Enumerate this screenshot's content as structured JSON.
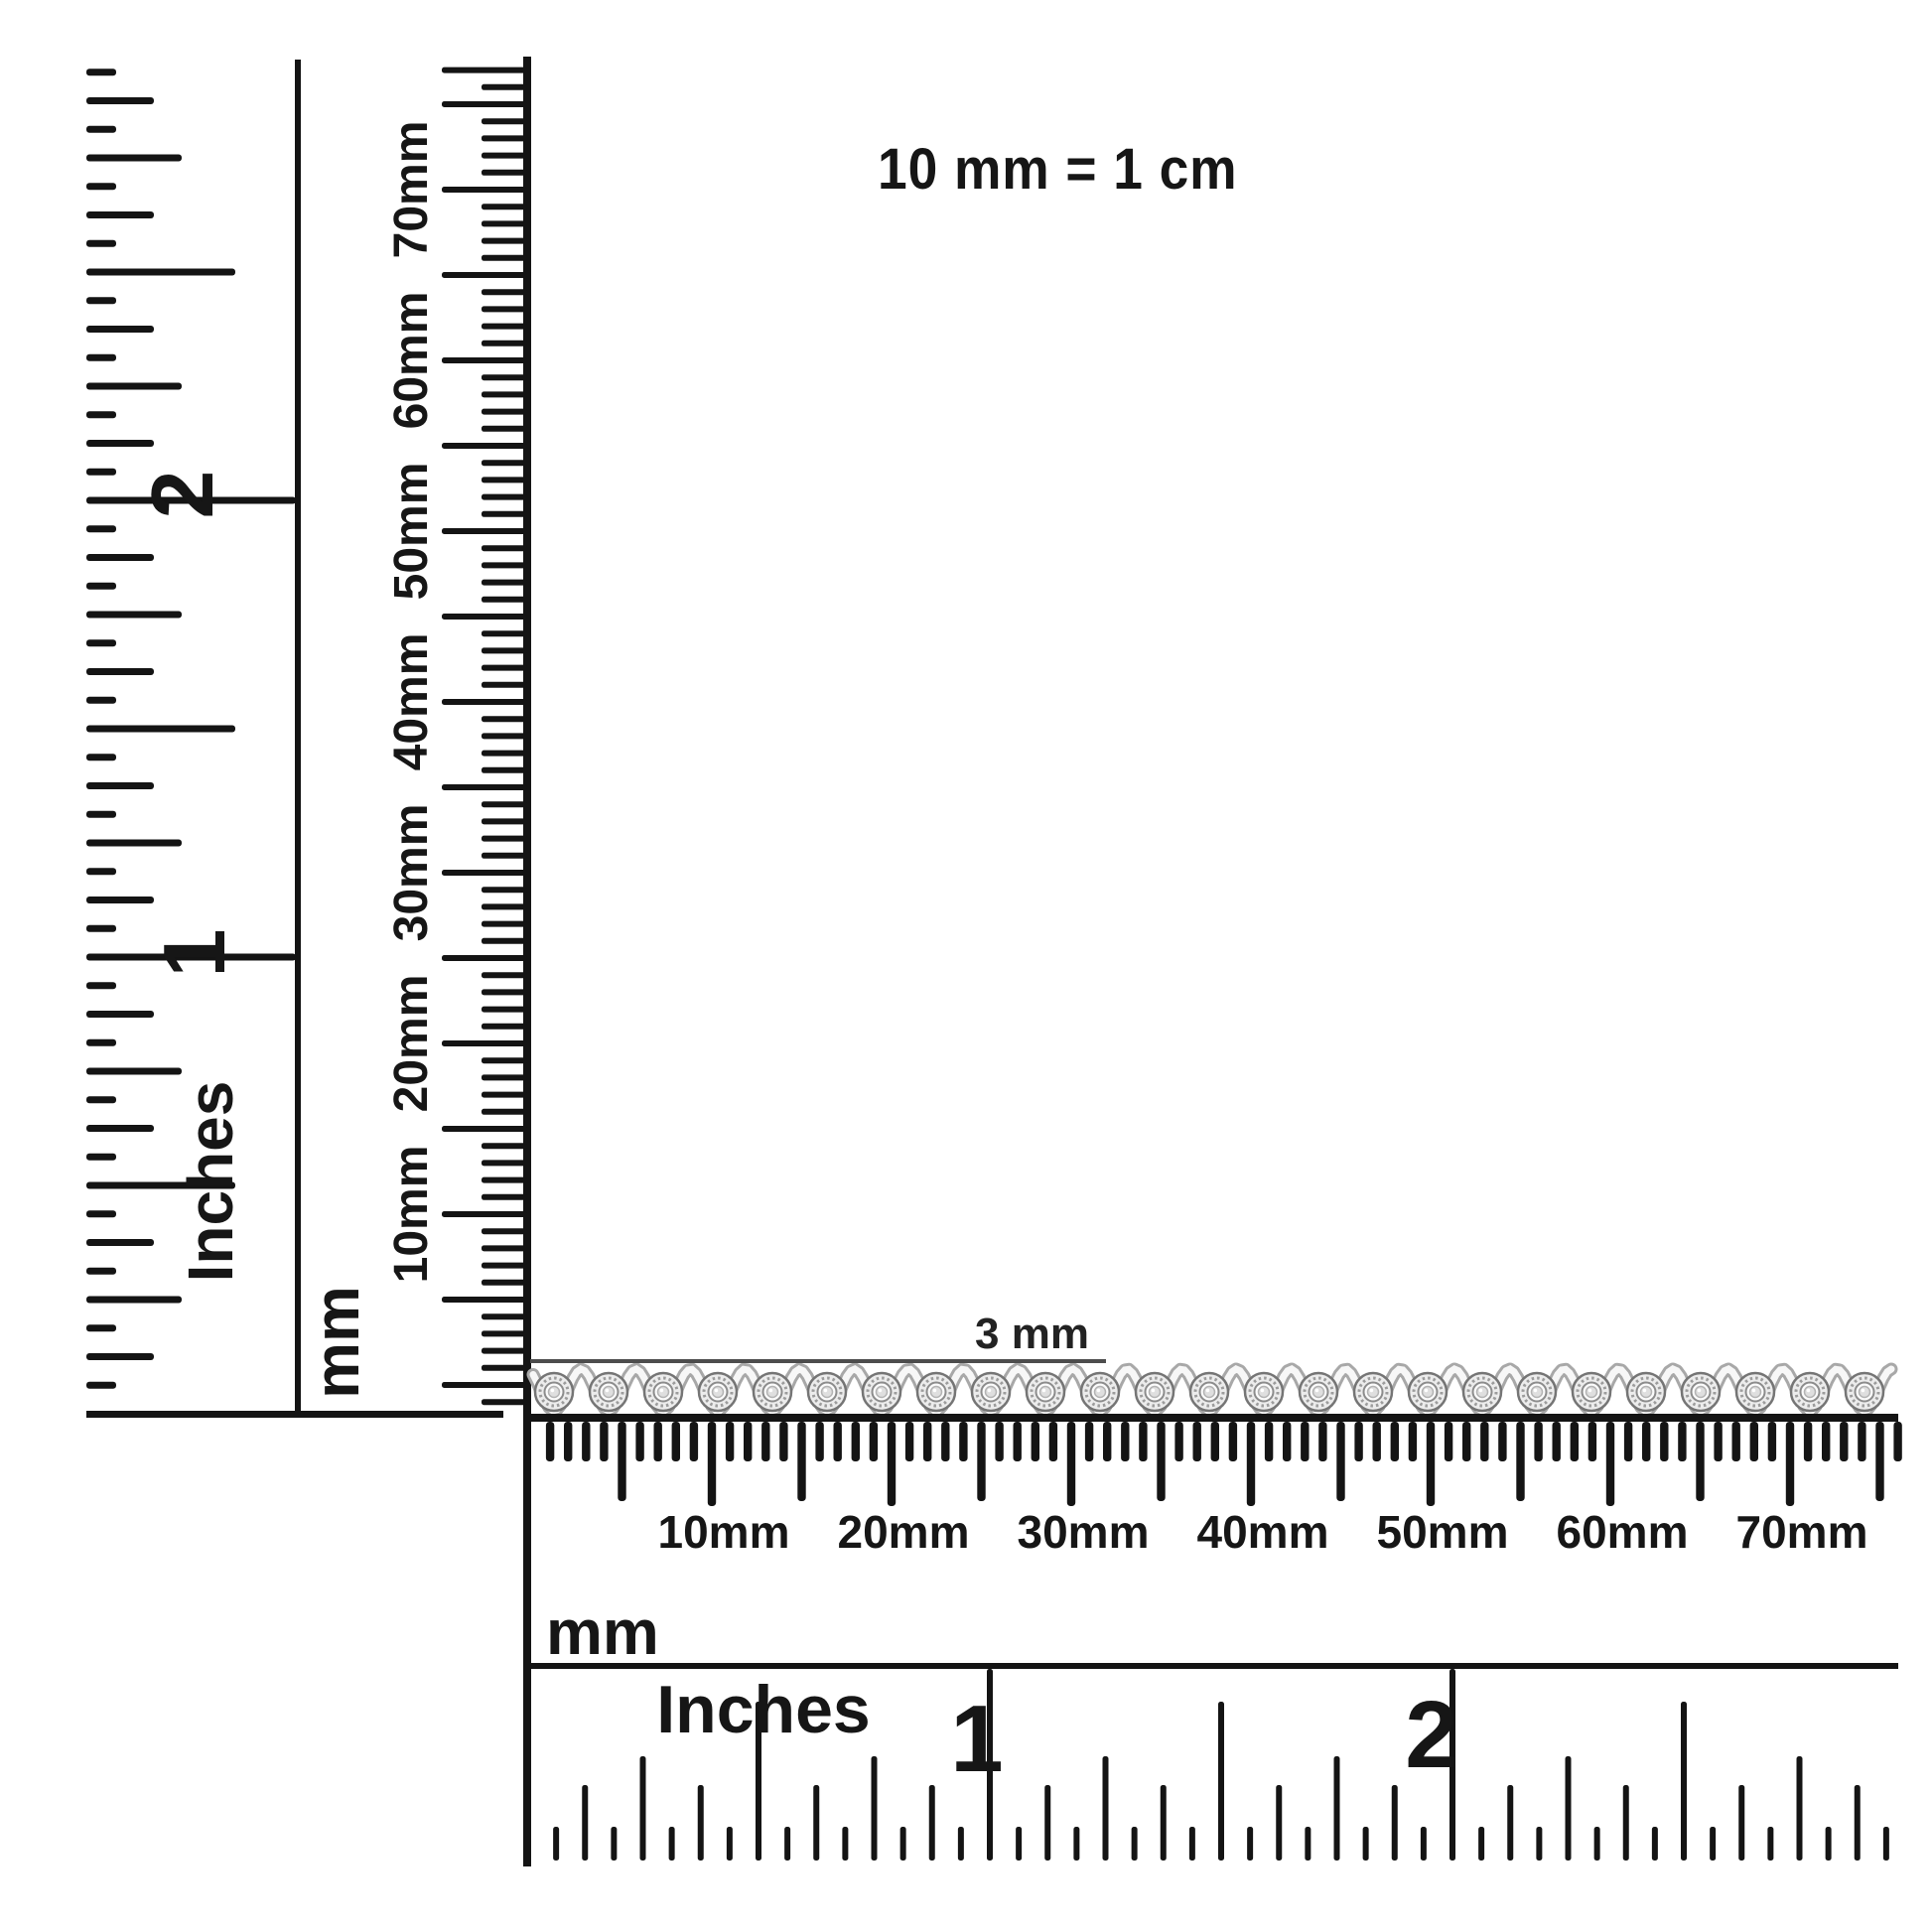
{
  "scale_note": "10 mm = 1 cm",
  "measurement": {
    "label": "3 mm"
  },
  "rulers": {
    "left_inches": {
      "unit": "Inches",
      "numerals": [
        "1",
        "2"
      ]
    },
    "vertical_mm": {
      "unit": "mm",
      "labels": [
        "10mm",
        "20mm",
        "30mm",
        "40mm",
        "50mm",
        "60mm",
        "70mm"
      ]
    },
    "horizontal_mm": {
      "unit": "mm",
      "labels": [
        "10mm",
        "20mm",
        "30mm",
        "40mm",
        "50mm",
        "60mm",
        "70mm"
      ]
    },
    "bottom_inches": {
      "unit": "Inches",
      "numerals": [
        "1",
        "2"
      ]
    }
  },
  "bracelet": {
    "link_count": 25,
    "stone_shape": "round",
    "colors": {
      "metal_light": "#f7f7f7",
      "metal_mid": "#ececec",
      "metal_shadow": "#a8a8a8",
      "outline": "#757575",
      "bezel_fill": "#fbfbfb",
      "stone_fill": "#dfdfdf",
      "measure_line": "#4d4d4d"
    }
  },
  "ink": "#141414"
}
